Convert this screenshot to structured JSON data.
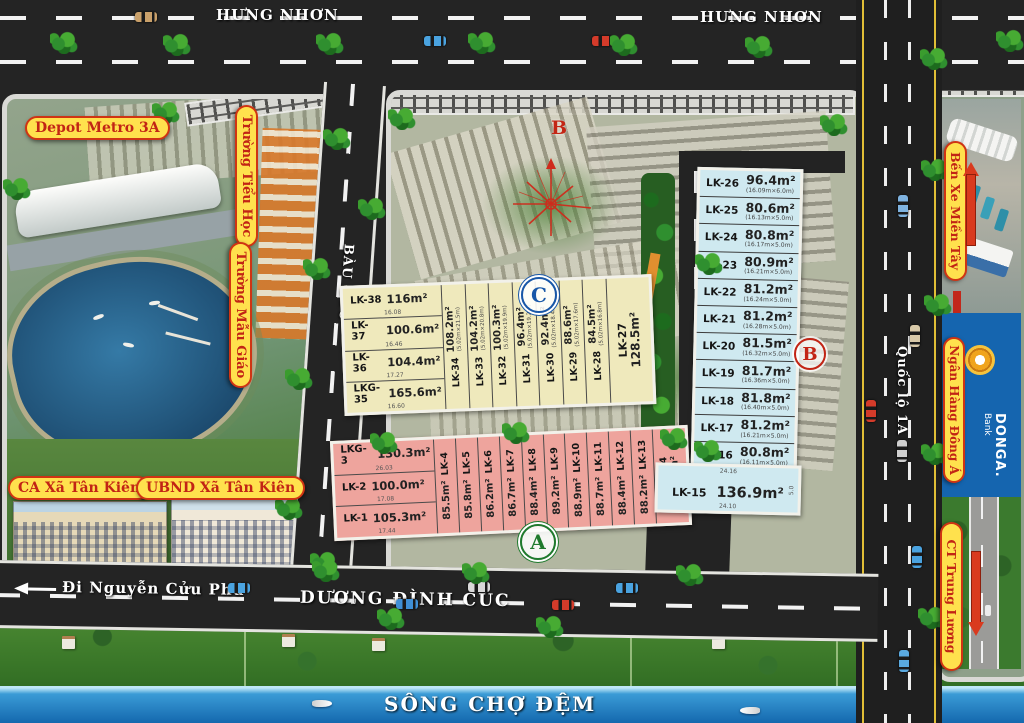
{
  "compass": {
    "north_letter": "B"
  },
  "roads": {
    "hung_nhon_left": "HƯNG NHƠN",
    "hung_nhon_right": "HƯNG NHƠN",
    "bau_goc": "BÀU GỐC",
    "quoc_lo_1a": "Quốc lộ 1A",
    "duong_dinh_cuc": "DƯƠNG ĐÌNH CÚC",
    "di_nguyen_cuu_phu": "Đi Nguyễn Cửu Phú",
    "song_cho_dem": "SÔNG CHỢ ĐỆM"
  },
  "landmarks": {
    "depot_metro": "Depot Metro 3A",
    "truong_tieu_hoc": "Trường Tiểu Học",
    "truong_mau_giao": "Trường Mẫu Giáo",
    "ca_xa_tan_kien": "CA Xã Tân Kiên",
    "ubnd_xa_tan_kien": "UBND Xã Tân Kiên",
    "ben_xe_mien_tay": "Bến Xe Miền Tây",
    "ngan_hang_dong_a": "Ngân Hàng Đông Á",
    "donga_logo": "DONGA.",
    "donga_sub": "Bank",
    "ct_trung_luong": "CT Trung Lương"
  },
  "sections": {
    "a": "A",
    "b": "B",
    "c": "C"
  },
  "blocks": {
    "c_yellow": {
      "rows": [
        {
          "id": "LK-38",
          "area": "116m²",
          "dim": "16.08"
        },
        {
          "id": "LK-37",
          "area": "100.6m²",
          "dim": "16.46"
        },
        {
          "id": "LK-36",
          "area": "104.4m²",
          "dim": "17.27"
        },
        {
          "id": "LKG-35",
          "area": "165.6m²",
          "dim": "16.60"
        }
      ],
      "strips": [
        {
          "id": "LK-34",
          "area": "108.2m²",
          "dims": "(5.02m×21.5m)"
        },
        {
          "id": "LK-33",
          "area": "104.2m²",
          "dims": "(5.02m×20.8m)"
        },
        {
          "id": "LK-32",
          "area": "100.3m²",
          "dims": "(5.02m×19.9m)"
        },
        {
          "id": "LK-31",
          "area": "96.4m²",
          "dims": "(5.02m×19.2m)"
        },
        {
          "id": "LK-30",
          "area": "92.4m²",
          "dims": "(5.02m×18.4m)"
        },
        {
          "id": "LK-29",
          "area": "88.6m²",
          "dims": "(5.02m×17.6m)"
        },
        {
          "id": "LK-28",
          "area": "84.5m²",
          "dims": "(5.02m×16.8m)"
        }
      ],
      "corner": {
        "id": "LK-27",
        "area": "128.5m²"
      }
    },
    "a_pink": {
      "rows": [
        {
          "id": "LKG-3",
          "area": "130.3m²",
          "dim": "26.03"
        },
        {
          "id": "LK-2",
          "area": "100.0m²",
          "dim": "17.08"
        },
        {
          "id": "LK-1",
          "area": "105.3m²",
          "dim": "17.44"
        }
      ],
      "strips": [
        {
          "id": "LK-4",
          "area": "85.5m²"
        },
        {
          "id": "LK-5",
          "area": "85.8m²"
        },
        {
          "id": "LK-6",
          "area": "86.2m²"
        },
        {
          "id": "LK-7",
          "area": "86.7m²"
        },
        {
          "id": "LK-8",
          "area": "88.4m²"
        },
        {
          "id": "LK-9",
          "area": "89.2m²"
        },
        {
          "id": "LK-10",
          "area": "88.9m²"
        },
        {
          "id": "LK-11",
          "area": "88.7m²"
        },
        {
          "id": "LK-12",
          "area": "88.4m²"
        },
        {
          "id": "LK-13",
          "area": "88.2m²"
        }
      ],
      "corner": {
        "id": "LKG-14",
        "area": "87.8m²"
      }
    },
    "b_blue": {
      "rows": [
        {
          "id": "LK-26",
          "area": "96.4m²",
          "dims": "(16.09m×6.0m)"
        },
        {
          "id": "LK-25",
          "area": "80.6m²",
          "dims": "(16.13m×5.0m)"
        },
        {
          "id": "LK-24",
          "area": "80.8m²",
          "dims": "(16.17m×5.0m)"
        },
        {
          "id": "LK-23",
          "area": "80.9m²",
          "dims": "(16.21m×5.0m)"
        },
        {
          "id": "LK-22",
          "area": "81.2m²",
          "dims": "(16.24m×5.0m)"
        },
        {
          "id": "LK-21",
          "area": "81.2m²",
          "dims": "(16.28m×5.0m)"
        },
        {
          "id": "LK-20",
          "area": "81.5m²",
          "dims": "(16.32m×5.0m)"
        },
        {
          "id": "LK-19",
          "area": "81.7m²",
          "dims": "(16.36m×5.0m)"
        },
        {
          "id": "LK-18",
          "area": "81.8m²",
          "dims": "(16.40m×5.0m)"
        },
        {
          "id": "LK-17",
          "area": "81.2m²",
          "dims": "(16.21m×5.0m)"
        },
        {
          "id": "LK-16",
          "area": "80.8m²",
          "dims": "(16.11m×5.0m)"
        }
      ],
      "corner": {
        "id": "LK-15",
        "area": "136.9m²",
        "top_dim": "24.16",
        "bottom_dim": "24.10",
        "side_dim": "5.0"
      }
    }
  }
}
